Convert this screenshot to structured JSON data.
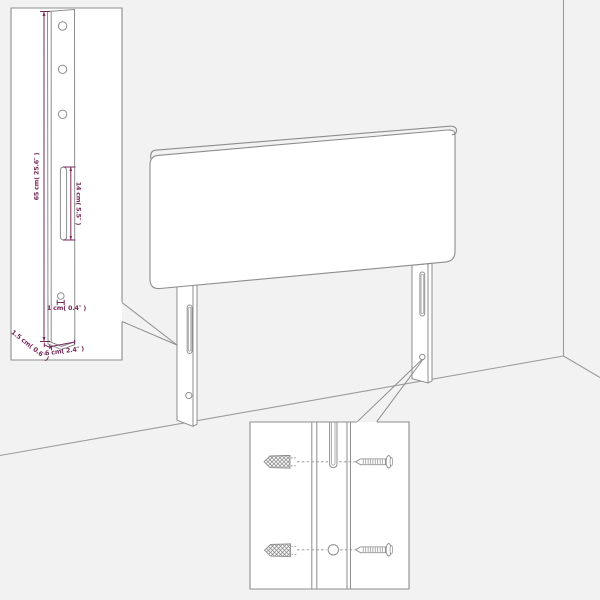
{
  "diagram": {
    "type": "furniture-assembly-diagram",
    "subject": "headboard with wall-mount legs",
    "colors": {
      "background": "#f2f2f2",
      "inset_background": "#ffffff",
      "line": "#8d8d8d",
      "wall_line": "#9b9b9b",
      "dimension_accent": "#76295a"
    },
    "dimensions": {
      "height": "65 cm( 25.6″ )",
      "slot_height": "14 cm( 5.5″ )",
      "hole_diameter": "1 cm( 0.4″ )",
      "thickness": "1.5 cm( 0.6″ )",
      "depth": "6 cm( 2.4″ )"
    }
  }
}
